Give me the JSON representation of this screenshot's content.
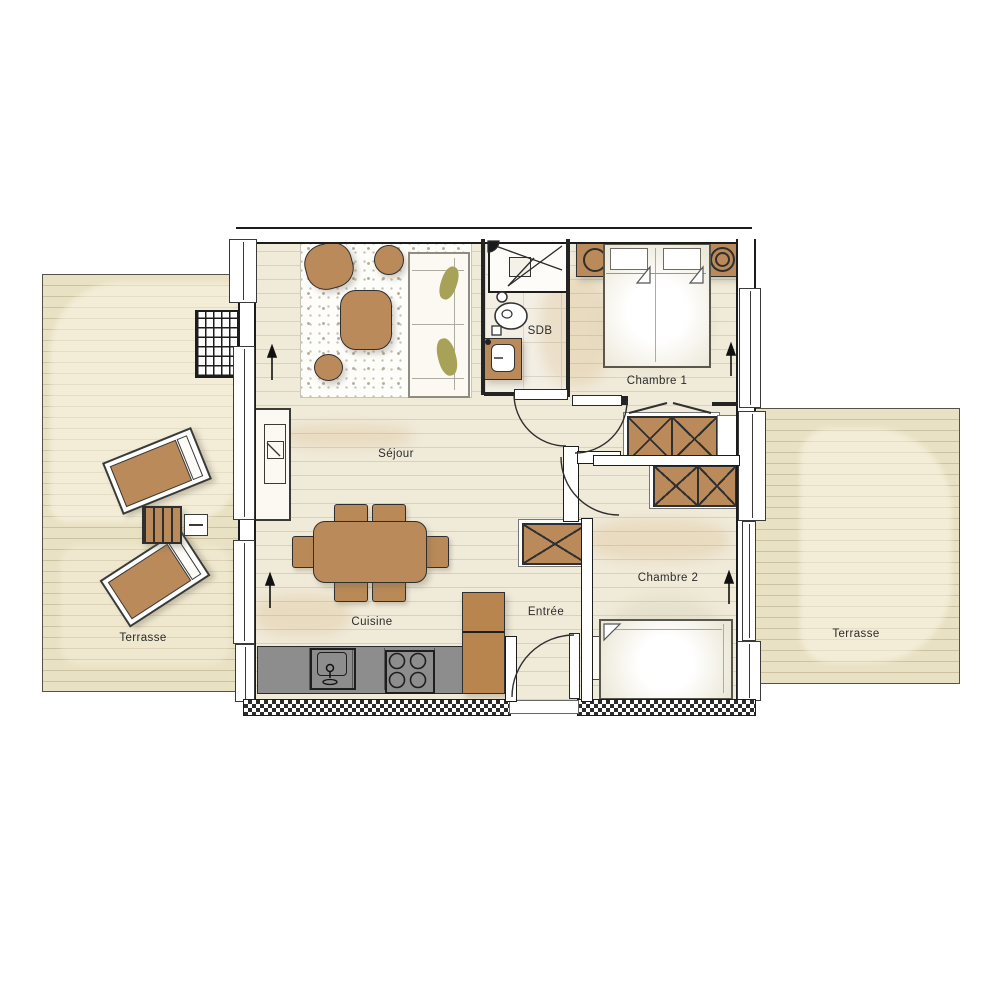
{
  "document": {
    "type": "apartment-floor-plan",
    "language": "fr"
  },
  "labels": {
    "sejour": "Séjour",
    "cuisine": "Cuisine",
    "entree": "Entrée",
    "sdb": "SDB",
    "chambre1": "Chambre 1",
    "chambre2": "Chambre 2",
    "terrasse_left": "Terrasse",
    "terrasse_right": "Terrasse"
  },
  "colors": {
    "furniture_wood": "#bb8a5a",
    "deck_beige": "#e9e1c3",
    "floor_beige": "#f0ead9",
    "counter_gray": "#8d8d8d",
    "wall_dark": "#1f1f1f",
    "accent_olive": "#a7a258",
    "paper_white": "#ffffff"
  }
}
